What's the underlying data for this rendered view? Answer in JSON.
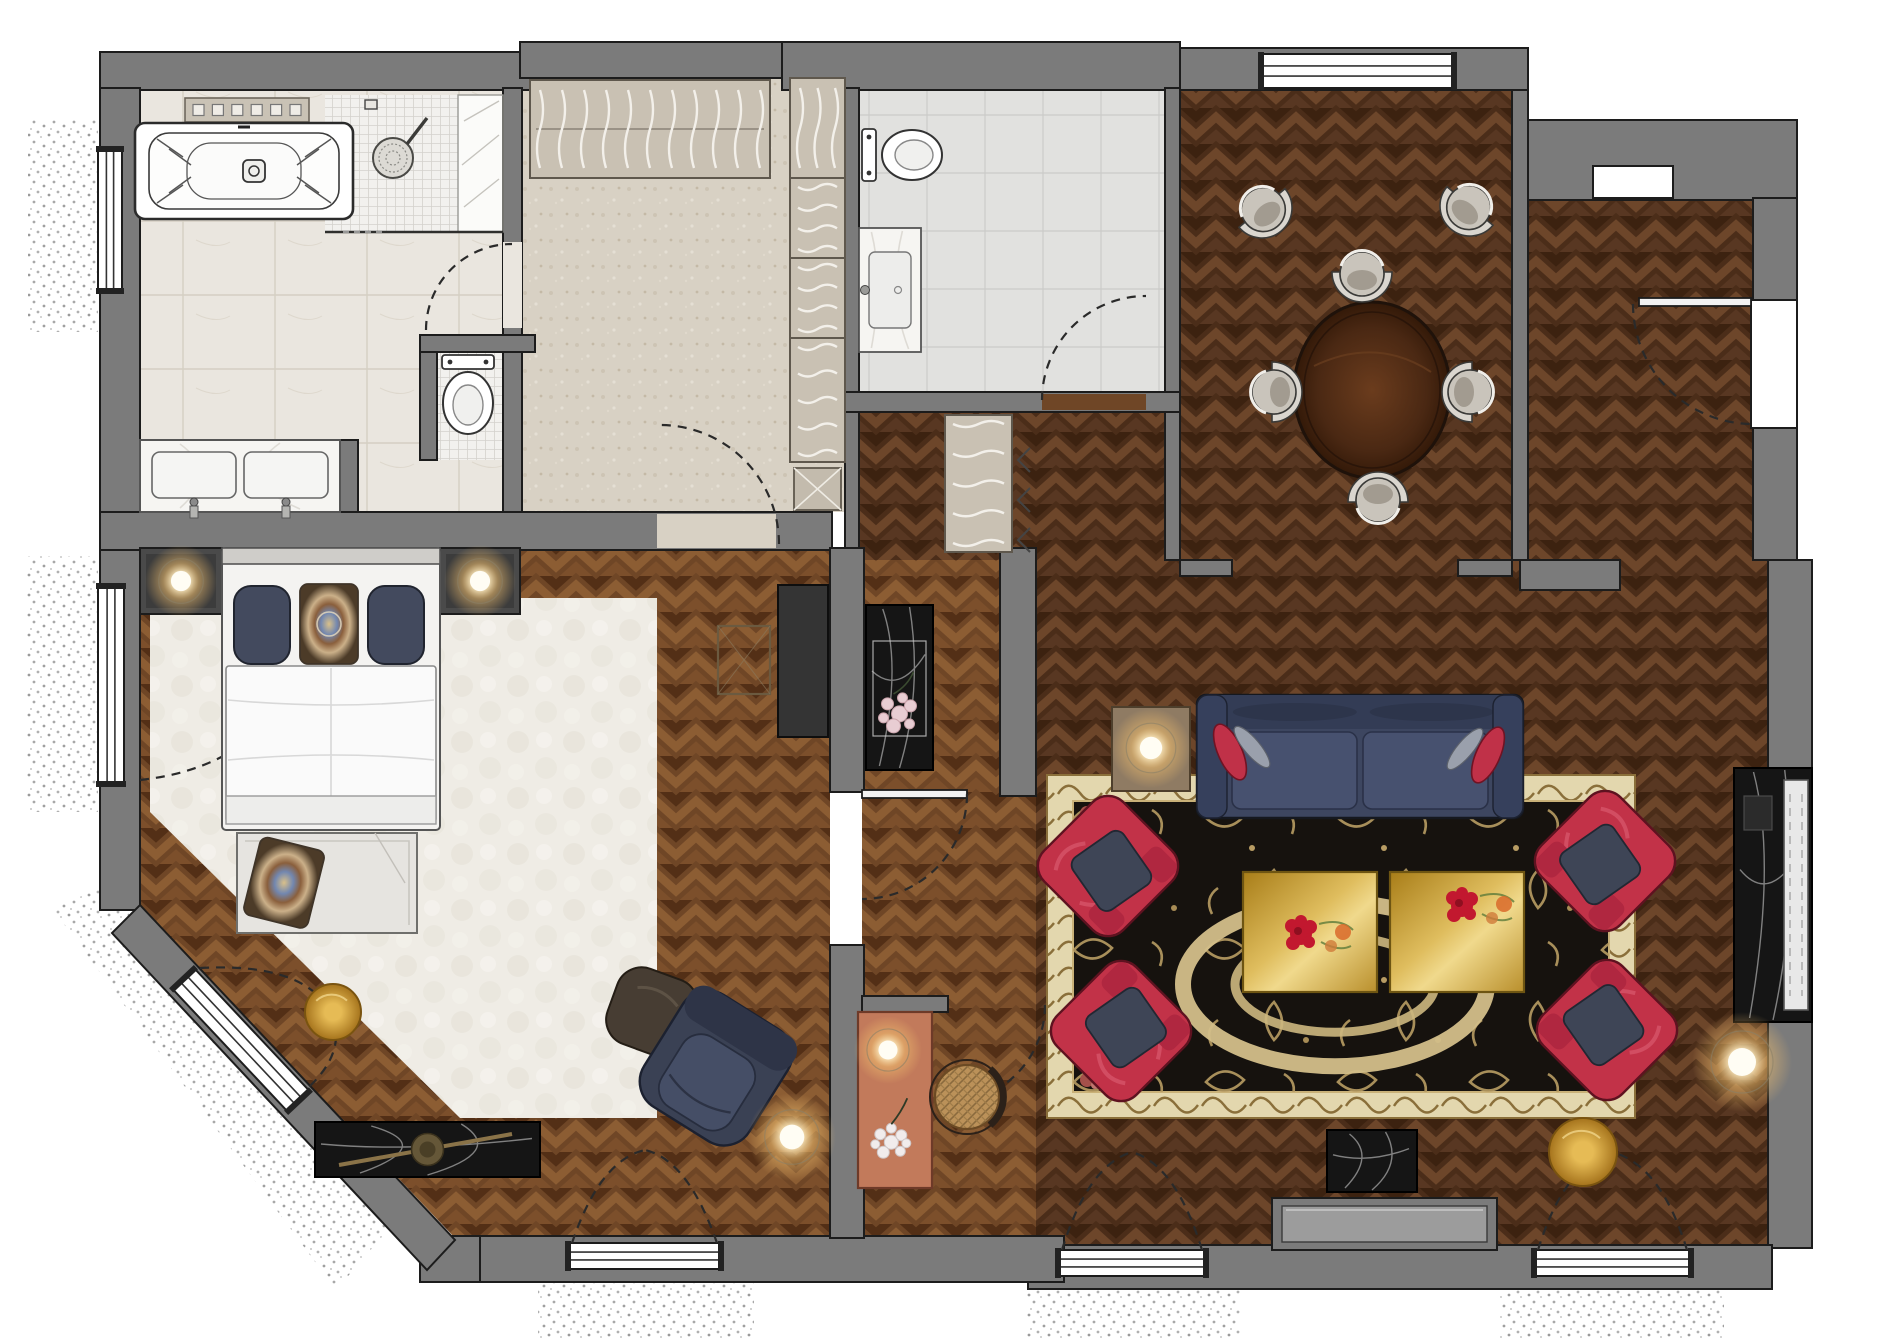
{
  "meta": {
    "width": 1877,
    "height": 1340,
    "background": "#ffffff",
    "kind": "rendered-floor-plan"
  },
  "palette": {
    "wall": "#7b7b7b",
    "wallStroke": "#1c1c1c",
    "parquetDark": "#4b2d19",
    "parquetLight": "#6f4626",
    "tileBath": "#eae6df",
    "tileWC": "#e1e1df",
    "mosaic": "#f2f1ee",
    "carpet": "#d8d1c4",
    "bedRug": "#efece5",
    "rugField": "#16120e",
    "rugBorder": "#e3d7ae",
    "rugGold": "#b89c63",
    "sofaNavy": "#3d4660",
    "chairRed": "#c23248",
    "gold": "#d4a439",
    "salmon": "#c27a5b",
    "marbleBlack": "#151515",
    "marbleWhite": "#f6f5f2",
    "glow": "#f0be6e"
  },
  "rooms": [
    {
      "name": "bathroom"
    },
    {
      "name": "shower"
    },
    {
      "name": "dressing-room"
    },
    {
      "name": "guest-wc"
    },
    {
      "name": "entrance-hall"
    },
    {
      "name": "dining-room"
    },
    {
      "name": "entry-corridor"
    },
    {
      "name": "living-room"
    },
    {
      "name": "bedroom"
    },
    {
      "name": "desk-nook"
    }
  ],
  "scene": {
    "stipple": [
      {
        "n": "balcony-bath-west",
        "rect": [
          28,
          118,
          70,
          214
        ]
      },
      {
        "n": "balcony-bedroom-west",
        "rect": [
          26,
          556,
          72,
          256
        ]
      },
      {
        "n": "balcony-chamfer",
        "poly": [
          [
            52,
            908
          ],
          [
            106,
            886
          ],
          [
            388,
            1230
          ],
          [
            336,
            1290
          ]
        ]
      },
      {
        "n": "balcony-bedroom-south",
        "rect": [
          538,
          1268,
          216,
          70
        ]
      },
      {
        "n": "balcony-living-left",
        "rect": [
          1026,
          1278,
          214,
          60
        ]
      },
      {
        "n": "balcony-living-right",
        "rect": [
          1500,
          1278,
          224,
          60
        ]
      }
    ],
    "floors": [
      {
        "n": "floor-bathroom",
        "k": "tileB",
        "rect": [
          140,
          88,
          363,
          424
        ]
      },
      {
        "n": "floor-shower-mosaic",
        "k": "mos",
        "rect": [
          325,
          95,
          133,
          137
        ]
      },
      {
        "n": "floor-shower-bench",
        "k": "plain",
        "fill": "#fbfbf9",
        "rect": [
          458,
          95,
          45,
          137
        ]
      },
      {
        "n": "floor-toilet-mosaic",
        "k": "mos",
        "rect": [
          437,
          352,
          66,
          108
        ]
      },
      {
        "n": "floor-dressing",
        "k": "carpet",
        "rect": [
          522,
          78,
          323,
          434
        ]
      },
      {
        "n": "floor-wc",
        "k": "tileW",
        "rect": [
          859,
          90,
          306,
          302
        ]
      },
      {
        "n": "floor-hall-upper",
        "k": "pqD",
        "rect": [
          859,
          412,
          306,
          148
        ]
      },
      {
        "n": "floor-hall-lower",
        "k": "pqL",
        "rect": [
          862,
          560,
          174,
          680
        ]
      },
      {
        "n": "floor-dining",
        "k": "pqD",
        "rect": [
          1180,
          90,
          332,
          470
        ]
      },
      {
        "n": "floor-corridor",
        "k": "pqD",
        "rect": [
          1528,
          200,
          225,
          360
        ]
      },
      {
        "n": "floor-living",
        "k": "pqD",
        "rect": [
          1036,
          560,
          732,
          685
        ]
      },
      {
        "n": "floor-bedroom",
        "k": "pqL",
        "poly": [
          [
            140,
            548
          ],
          [
            830,
            548
          ],
          [
            830,
            1238
          ],
          [
            455,
            1238
          ],
          [
            140,
            906
          ]
        ]
      },
      {
        "n": "rug-bedroom",
        "k": "rugB",
        "poly": [
          [
            150,
            598
          ],
          [
            657,
            598
          ],
          [
            657,
            1118
          ],
          [
            460,
            1118
          ],
          [
            150,
            812
          ]
        ]
      }
    ],
    "walls": [
      {
        "n": "wall-top-bathroom",
        "rect": [
          100,
          52,
          430,
          38
        ]
      },
      {
        "n": "wall-top-dressing",
        "rect": [
          520,
          42,
          264,
          36
        ]
      },
      {
        "n": "wall-top-wc",
        "rect": [
          782,
          42,
          398,
          48
        ]
      },
      {
        "n": "wall-top-dining",
        "rect": [
          1180,
          48,
          348,
          42
        ]
      },
      {
        "n": "wall-top-entry",
        "rect": [
          1513,
          120,
          284,
          80
        ]
      },
      {
        "n": "wall-dining-east",
        "rect": [
          1512,
          90,
          16,
          470
        ]
      },
      {
        "n": "wall-dining-west",
        "rect": [
          1165,
          88,
          15,
          472
        ]
      },
      {
        "n": "wall-east-corridor",
        "rect": [
          1753,
          198,
          44,
          362
        ]
      },
      {
        "n": "wall-east-living-a",
        "rect": [
          1768,
          560,
          44,
          210
        ]
      },
      {
        "n": "wall-east-living-b",
        "rect": [
          1768,
          1020,
          44,
          228
        ]
      },
      {
        "n": "wall-south-living",
        "rect": [
          1028,
          1245,
          744,
          44
        ]
      },
      {
        "n": "wall-south-bedroom",
        "rect": [
          452,
          1236,
          612,
          46
        ]
      },
      {
        "n": "wall-fill-sw",
        "rect": [
          420,
          1236,
          60,
          46
        ]
      },
      {
        "n": "wall-west-bathroom",
        "rect": [
          100,
          88,
          40,
          462
        ]
      },
      {
        "n": "wall-west-bedroom",
        "rect": [
          100,
          550,
          40,
          360
        ]
      },
      {
        "n": "wall-chamfer",
        "poly": [
          [
            140,
            905
          ],
          [
            455,
            1240
          ],
          [
            427,
            1270
          ],
          [
            112,
            933
          ]
        ]
      },
      {
        "n": "wall-mid-south",
        "rect": [
          100,
          512,
          732,
          38
        ]
      },
      {
        "n": "wall-bath-dressing",
        "rect": [
          503,
          88,
          19,
          424
        ]
      },
      {
        "n": "wall-dressing-east",
        "rect": [
          845,
          88,
          14,
          462
        ]
      },
      {
        "n": "wall-wc-south",
        "rect": [
          845,
          392,
          335,
          20
        ]
      },
      {
        "n": "wall-vanity-stub",
        "rect": [
          340,
          440,
          18,
          72
        ]
      },
      {
        "n": "wall-toilet-stub-v",
        "rect": [
          420,
          335,
          17,
          125
        ]
      },
      {
        "n": "wall-toilet-stub-h",
        "rect": [
          420,
          335,
          115,
          17
        ]
      },
      {
        "n": "wall-bedroom-east-a",
        "rect": [
          830,
          548,
          34,
          244
        ]
      },
      {
        "n": "wall-bedroom-east-b",
        "rect": [
          830,
          945,
          34,
          293
        ]
      },
      {
        "n": "wall-nook-top",
        "rect": [
          862,
          996,
          86,
          16
        ]
      },
      {
        "n": "wall-hall-east",
        "rect": [
          1000,
          548,
          36,
          248
        ]
      },
      {
        "n": "wall-dining-stub-w",
        "rect": [
          1180,
          560,
          52,
          16
        ]
      },
      {
        "n": "wall-dining-stub-e",
        "rect": [
          1458,
          560,
          54,
          16
        ]
      },
      {
        "n": "wall-corridor-stub",
        "rect": [
          1520,
          560,
          100,
          30
        ]
      }
    ],
    "windows": [
      {
        "n": "window-bathroom-west",
        "o": "v",
        "x": 98,
        "y": 148,
        "w": 24,
        "h": 144
      },
      {
        "n": "french-window-bedroom-west",
        "o": "v",
        "x": 98,
        "y": 585,
        "w": 26,
        "h": 200
      },
      {
        "n": "window-chamfer",
        "o": "r",
        "x": 156,
        "y": 1025,
        "w": 170,
        "h": 30,
        "rot": 46.8,
        "cx": 241,
        "cy": 1040
      },
      {
        "n": "french-window-bedroom-south",
        "o": "h",
        "x": 567,
        "y": 1243,
        "w": 155,
        "h": 26
      },
      {
        "n": "french-window-living-left",
        "o": "h",
        "x": 1057,
        "y": 1250,
        "w": 150,
        "h": 26
      },
      {
        "n": "french-window-living-right",
        "o": "h",
        "x": 1533,
        "y": 1250,
        "w": 159,
        "h": 26
      },
      {
        "n": "window-dining-north",
        "o": "h",
        "x": 1260,
        "y": 54,
        "w": 195,
        "h": 34
      },
      {
        "n": "niche-entry",
        "o": "h",
        "x": 1593,
        "y": 166,
        "w": 80,
        "h": 32,
        "plain": 1
      },
      {
        "n": "entry-door-gap",
        "o": "v",
        "x": 1751,
        "y": 300,
        "w": 46,
        "h": 128,
        "plain": 1
      }
    ],
    "doors": [
      {
        "n": "door-bathroom-dressing",
        "gap": [
          503,
          242,
          19,
          86
        ],
        "gapFill": "#eae6df",
        "arc": "M426,330 A86,86 0 0 1 512,244"
      },
      {
        "n": "door-dressing-bedroom",
        "gap": [
          657,
          514,
          119,
          34
        ],
        "gapFill": "#d8d1c4",
        "arc": "M779,544 A119,119 0 0 0 660,425"
      },
      {
        "n": "door-wc",
        "gap": [
          1042,
          394,
          104,
          16
        ],
        "gapFill": "#6f4626",
        "arc": "M1042,400 A104,104 0 0 1 1146,296"
      },
      {
        "n": "door-entry",
        "leaf": [
          1639,
          298,
          112,
          8
        ],
        "arc": "M1633,304 A120,120 0 0 0 1751,424"
      },
      {
        "n": "door-bedroom-hall",
        "leaf": [
          862,
          790,
          105,
          8
        ],
        "arc": "M967,794 A105,105 0 0 1 862,899"
      },
      {
        "n": "door-hall-living",
        "arc": "M1045,1005 A98,98 0 0 1 947,1103"
      },
      {
        "n": "door-arcs-fd-bedroom",
        "arc2": [
          "M572,1243 Q600,1160 645,1150",
          "M717,1243 Q688,1160 645,1150"
        ]
      },
      {
        "n": "door-arcs-fd-living-left",
        "arc2": [
          "M1062,1250 Q1088,1165 1132,1152",
          "M1202,1250 Q1176,1165 1132,1152"
        ]
      },
      {
        "n": "door-arcs-fd-living-right",
        "arc2": [
          "M1538,1250 Q1564,1165 1612,1152",
          "M1687,1250 Q1661,1165 1612,1152"
        ]
      },
      {
        "n": "door-arcs-french-window-west",
        "arc2": [
          "M140,590 Q250,602 293,685",
          "M140,780 Q250,768 293,685"
        ]
      },
      {
        "n": "door-arcs-chamfer-window",
        "arc2": [
          "M200,968 Q310,962 333,1018",
          "M310,1086 Q345,1052 333,1018"
        ]
      }
    ],
    "furniture": [
      {
        "n": "area-rug",
        "t": "rug",
        "x": 1047,
        "y": 775,
        "w": 588,
        "h": 343,
        "b": 26
      },
      {
        "n": "bathtub-shelf",
        "t": "shelf",
        "x": 185,
        "y": 98,
        "w": 124,
        "h": 24
      },
      {
        "n": "bathtub",
        "t": "tub",
        "x": 135,
        "y": 123,
        "w": 218,
        "h": 96
      },
      {
        "n": "shower-set",
        "t": "shower",
        "hx": 393,
        "hy": 158,
        "bx": 458,
        "by": 95,
        "bw": 45,
        "bh": 137,
        "gx1": 325,
        "gy": 232,
        "gx2": 503
      },
      {
        "n": "toilet-bathroom",
        "t": "toiletV",
        "cx": 468,
        "y": 355
      },
      {
        "n": "vanity-double",
        "t": "vanity2",
        "x": 140,
        "y": 440,
        "w": 200,
        "h": 72
      },
      {
        "n": "wardrobe-top",
        "t": "closet",
        "x": 530,
        "y": 80,
        "w": 240,
        "h": 98,
        "dir": "v",
        "sq": 11,
        "rail": 1
      },
      {
        "n": "wardrobe-col-a",
        "t": "closet",
        "x": 790,
        "y": 78,
        "w": 55,
        "h": 100,
        "dir": "v",
        "sq": 3
      },
      {
        "n": "wardrobe-col-b",
        "t": "closet",
        "x": 790,
        "y": 178,
        "w": 55,
        "h": 80,
        "dir": "h",
        "sq": 4
      },
      {
        "n": "wardrobe-col-c",
        "t": "closet",
        "x": 790,
        "y": 258,
        "w": 55,
        "h": 80,
        "dir": "h",
        "sq": 4
      },
      {
        "n": "wardrobe-col-d",
        "t": "closet",
        "x": 790,
        "y": 338,
        "w": 55,
        "h": 124,
        "dir": "h",
        "sq": 5
      },
      {
        "n": "luggage-rack",
        "t": "xbox",
        "x": 794,
        "y": 468,
        "w": 47,
        "h": 42
      },
      {
        "n": "toilet-wc",
        "t": "toiletH",
        "x": 862,
        "cy": 155
      },
      {
        "n": "basin-wc",
        "t": "basin",
        "x": 859,
        "y": 228,
        "w": 62,
        "h": 124
      },
      {
        "n": "coat-closet",
        "t": "closet",
        "x": 945,
        "y": 415,
        "w": 67,
        "h": 137,
        "dir": "h",
        "sq": 5
      },
      {
        "n": "bifold-marks",
        "t": "chev",
        "x": 1018,
        "y": 448
      },
      {
        "n": "console-flowers-hall",
        "t": "flowerTable",
        "x": 866,
        "y": 605,
        "w": 67,
        "h": 165
      },
      {
        "n": "dining-table",
        "t": "dtable",
        "cx": 1372,
        "cy": 390,
        "rx": 78,
        "ry": 88
      },
      {
        "n": "dining-chair-n",
        "t": "dchair",
        "cx": 1362,
        "cy": 272,
        "rot": 0
      },
      {
        "n": "dining-chair-s",
        "t": "dchair",
        "cx": 1378,
        "cy": 502,
        "rot": 180
      },
      {
        "n": "dining-chair-w",
        "t": "dchair",
        "cx": 1272,
        "cy": 392,
        "rot": -90
      },
      {
        "n": "dining-chair-e",
        "t": "dchair",
        "cx": 1472,
        "cy": 392,
        "rot": 90
      },
      {
        "n": "dining-chair-nw",
        "t": "dchair",
        "cx": 1262,
        "cy": 208,
        "rot": -40
      },
      {
        "n": "dining-chair-ne",
        "t": "dchair",
        "cx": 1470,
        "cy": 206,
        "rot": 40
      },
      {
        "n": "sofa",
        "t": "sofa",
        "x": 1197,
        "y": 695,
        "w": 326,
        "h": 123
      },
      {
        "n": "sofa-side-table",
        "t": "sideTable",
        "x": 1112,
        "y": 707,
        "w": 78,
        "h": 84
      },
      {
        "n": "coffee-table-gold-left",
        "t": "goldTable",
        "x": 1243,
        "y": 872,
        "w": 134,
        "h": 120,
        "fx": 58,
        "fy": 62
      },
      {
        "n": "coffee-table-gold-right",
        "t": "goldTable",
        "x": 1390,
        "y": 872,
        "w": 134,
        "h": 120,
        "fx": 72,
        "fy": 34
      },
      {
        "n": "armchair-nw",
        "t": "armchair",
        "cx": 1108,
        "cy": 866,
        "rot": -45
      },
      {
        "n": "armchair-sw",
        "t": "armchair",
        "cx": 1121,
        "cy": 1031,
        "rot": -135
      },
      {
        "n": "armchair-ne",
        "t": "armchair",
        "cx": 1605,
        "cy": 861,
        "rot": 45
      },
      {
        "n": "armchair-se",
        "t": "armchair",
        "cx": 1607,
        "cy": 1030,
        "rot": 135
      },
      {
        "n": "fireplace",
        "t": "fireplace",
        "x": 1734,
        "y": 768,
        "w": 78,
        "h": 254
      },
      {
        "n": "window-seat",
        "t": "wseat",
        "x": 1272,
        "y": 1198,
        "w": 225,
        "h": 52
      },
      {
        "n": "side-table-marble",
        "t": "consoleBlk",
        "x": 1327,
        "y": 1130,
        "w": 90,
        "h": 62
      },
      {
        "n": "pouf-gold-living",
        "t": "pouf",
        "cx": 1583,
        "cy": 1152,
        "r": 34
      },
      {
        "n": "nightstand-left",
        "t": "nstand",
        "x": 140,
        "y": 548,
        "w": 82,
        "h": 66
      },
      {
        "n": "nightstand-right",
        "t": "nstand",
        "x": 440,
        "y": 548,
        "w": 80,
        "h": 66
      },
      {
        "n": "bed",
        "t": "bed",
        "x": 222,
        "y": 548,
        "w": 218,
        "h": 282
      },
      {
        "n": "bench",
        "t": "bench",
        "x": 237,
        "y": 833,
        "w": 180,
        "h": 100
      },
      {
        "n": "pouf-gold-bedroom",
        "t": "pouf",
        "cx": 333,
        "cy": 1012,
        "r": 28
      },
      {
        "n": "console-marble-bedroom",
        "t": "consoleBlk",
        "x": 315,
        "y": 1122,
        "w": 225,
        "h": 55,
        "decor": 1
      },
      {
        "n": "ottoman",
        "t": "ottoman",
        "cx": 652,
        "cy": 1012,
        "rot": 20
      },
      {
        "n": "lounge-chair",
        "t": "lounge",
        "cx": 716,
        "cy": 1068,
        "rot": 32
      },
      {
        "n": "tv-sideboard",
        "t": "tvboard",
        "x": 778,
        "y": 585,
        "w": 50,
        "h": 152
      },
      {
        "n": "stool",
        "t": "stool",
        "x": 718,
        "y": 626,
        "w": 52,
        "h": 68
      },
      {
        "n": "desk",
        "t": "desk",
        "x": 858,
        "y": 1012,
        "w": 74,
        "h": 176
      },
      {
        "n": "desk-chair-cane",
        "t": "cane",
        "cx": 967,
        "cy": 1097,
        "r": 32
      }
    ],
    "glows": [
      {
        "n": "lamp-nightstand-left",
        "cx": 181,
        "cy": 581,
        "r": 36
      },
      {
        "n": "lamp-nightstand-right",
        "cx": 480,
        "cy": 581,
        "r": 36
      },
      {
        "n": "lamp-sofa-table",
        "cx": 1151,
        "cy": 748,
        "r": 40
      },
      {
        "n": "floor-lamp-living",
        "cx": 1742,
        "cy": 1062,
        "r": 50
      },
      {
        "n": "floor-lamp-bedroom",
        "cx": 792,
        "cy": 1137,
        "r": 44
      },
      {
        "n": "lamp-desk",
        "cx": 888,
        "cy": 1050,
        "r": 34
      }
    ]
  }
}
